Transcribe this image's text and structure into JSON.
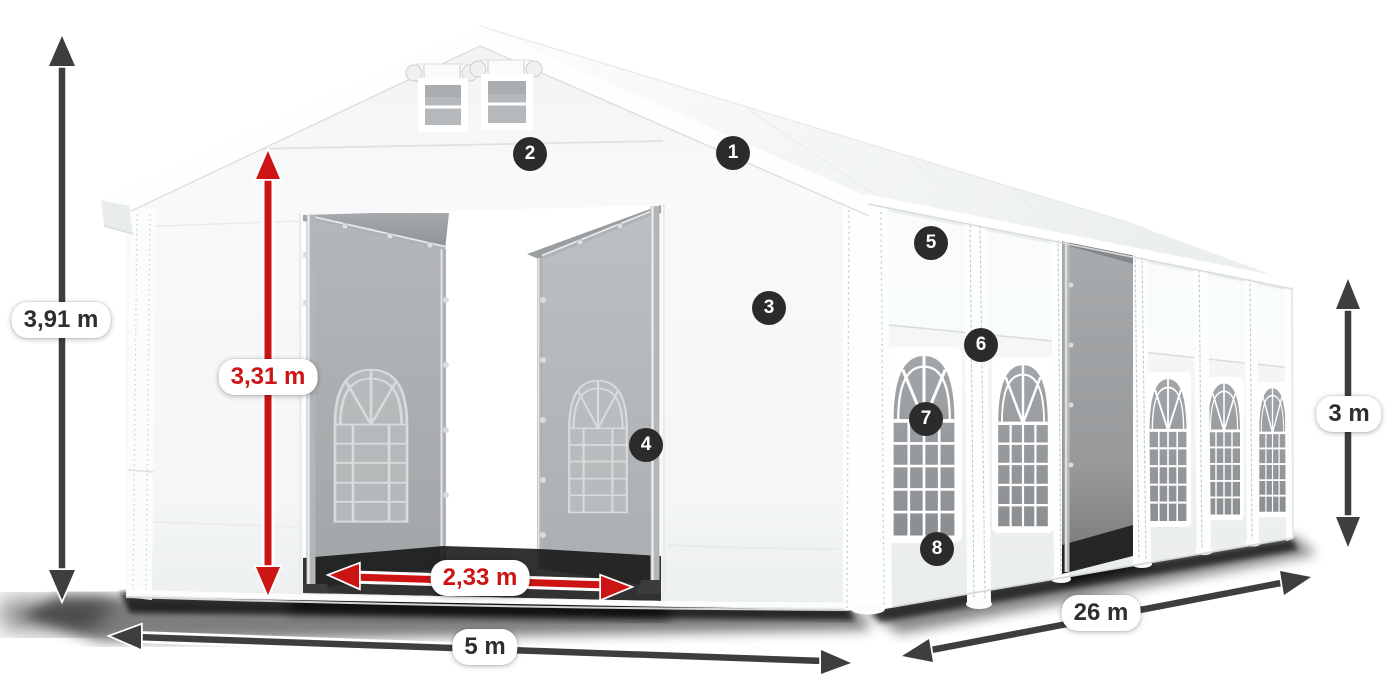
{
  "labels": {
    "total_height": "3,91 m",
    "entrance_height": "3,31 m",
    "entrance_width": "2,33 m",
    "front_width": "5 m",
    "length": "26 m",
    "side_height": "3 m"
  },
  "markers": [
    "1",
    "2",
    "3",
    "4",
    "5",
    "6",
    "7",
    "8"
  ],
  "colors": {
    "dimension_red": "#cc1414",
    "dimension_gray": "#3e3e40",
    "marker_background": "#2b2b2b",
    "marker_text": "#ffffff",
    "label_background": "#ffffff",
    "label_text": "#2e2e30",
    "tent_fabric": "#f5f6f7",
    "interior_fabric": "#a7aaac"
  }
}
